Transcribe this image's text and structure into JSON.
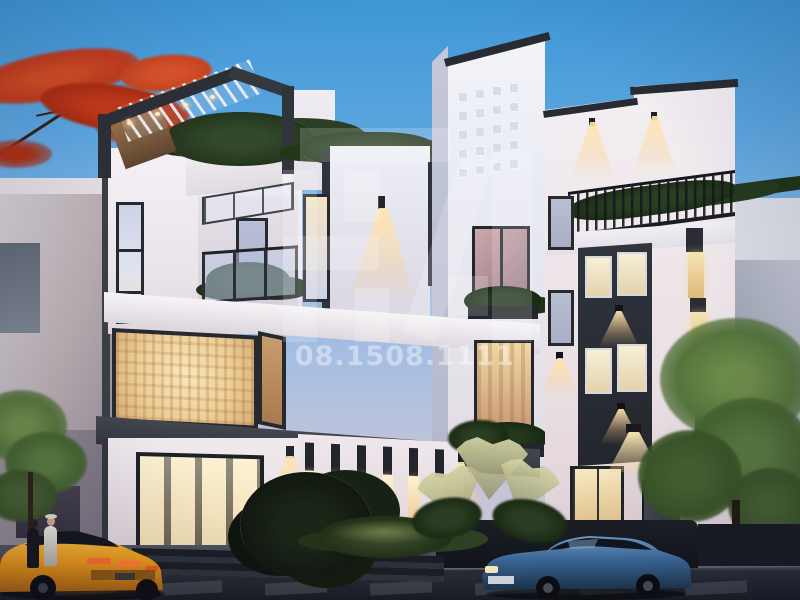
{
  "scene": {
    "type": "architectural-exterior-render",
    "subject": "Modern three-to-four storey white and dark-grey villa at dusk with warm lit windows, rooftop pergola with plants, balconies, two parked cars and street foreground",
    "time_of_day": "dusk"
  },
  "watermark": {
    "phone": "08.1508.1111",
    "logo": "HA blocky monogram",
    "blocks": [
      {
        "x": 300,
        "y": 128,
        "w": 150,
        "h": 34,
        "rot": 0
      },
      {
        "x": 283,
        "y": 170,
        "w": 34,
        "h": 172,
        "rot": 0
      },
      {
        "x": 283,
        "y": 236,
        "w": 96,
        "h": 34,
        "rot": 0
      },
      {
        "x": 345,
        "y": 170,
        "w": 34,
        "h": 52,
        "rot": 0
      },
      {
        "x": 355,
        "y": 288,
        "w": 34,
        "h": 54,
        "rot": 0
      },
      {
        "x": 432,
        "y": 150,
        "w": 34,
        "h": 192,
        "rot": 18
      },
      {
        "x": 492,
        "y": 150,
        "w": 40,
        "h": 192,
        "rot": 0
      },
      {
        "x": 448,
        "y": 276,
        "w": 40,
        "h": 40,
        "rot": 0
      }
    ]
  },
  "building": {
    "tower_grid": {
      "rows": 5,
      "cols": 4
    },
    "ground_slats": {
      "count": 6
    }
  },
  "street": {
    "crosswalk_dashes": {
      "count": 7
    }
  },
  "palette": {
    "sky_top": "#3e97d6",
    "sky_horizon": "#cdc6d6",
    "facade_white": "#f3f0f4",
    "dark_trim": "#2c2f35",
    "warm_window": "#f2d9a8",
    "warm_glow": "#e8a95c",
    "red_foliage": "#bf3a1c",
    "green_foliage": "#4f7038",
    "street_asphalt": "#23262c",
    "car_yellow": "#e89618",
    "car_blue": "#3a6898"
  }
}
